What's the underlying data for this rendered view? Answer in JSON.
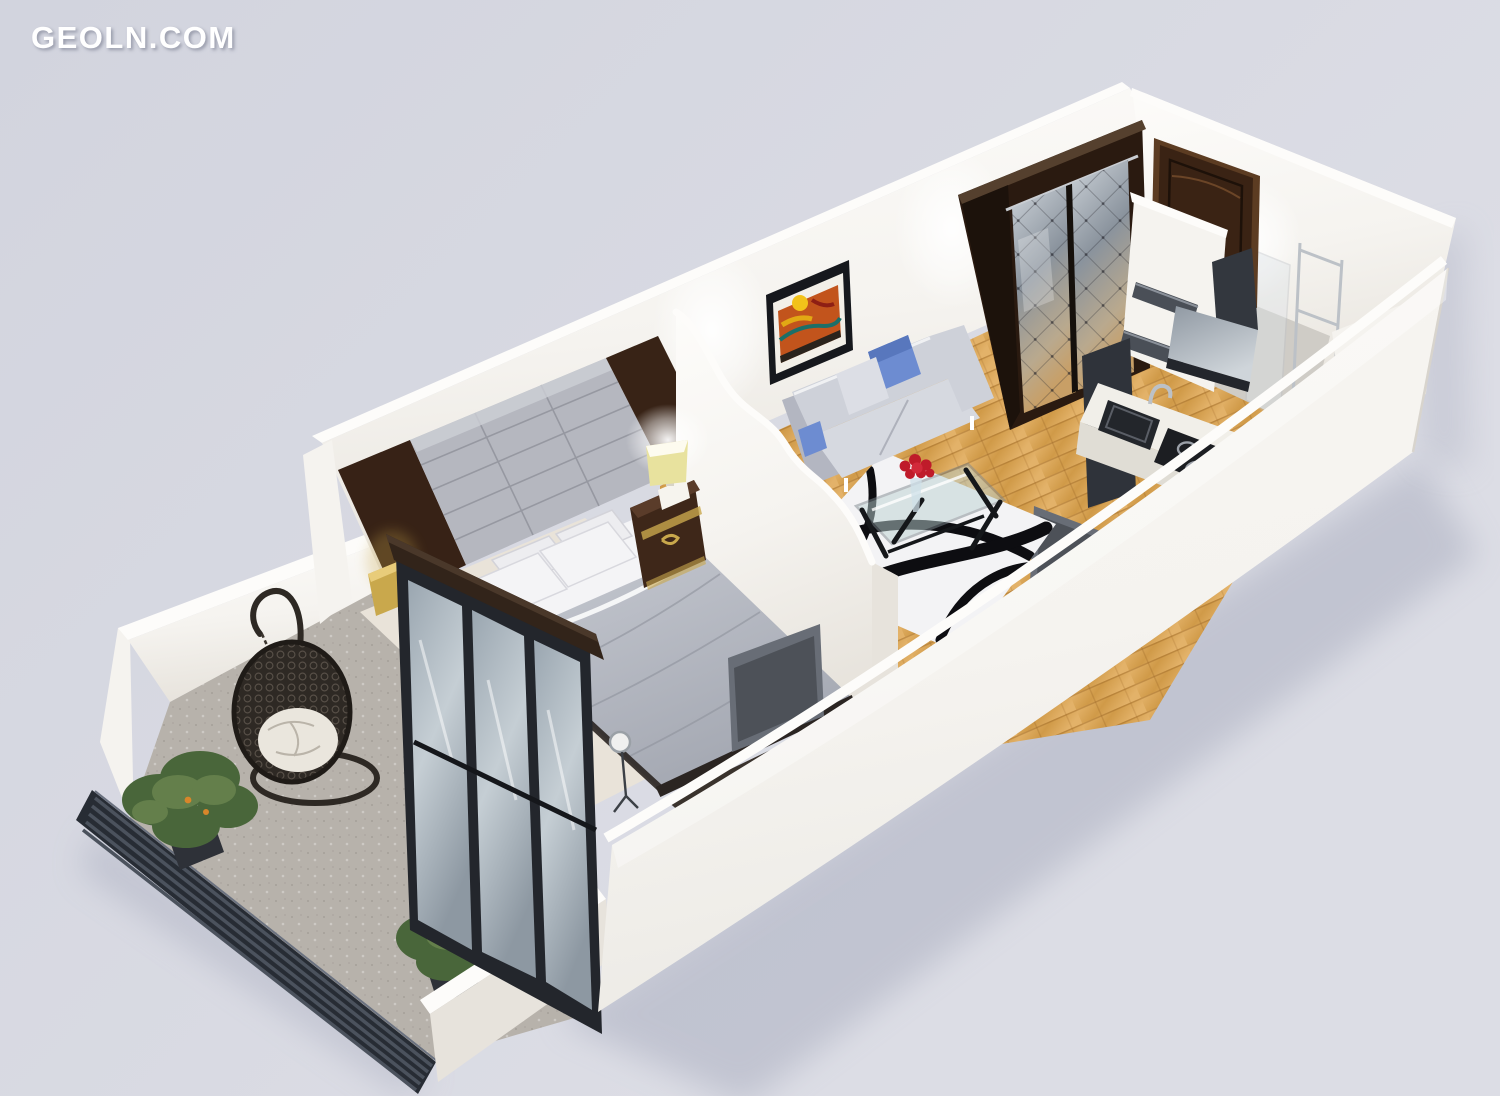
{
  "watermark": {
    "text": "GEOLN.COM"
  },
  "palette": {
    "bg1": "#d2d4de",
    "bg2": "#dcdde5",
    "shadow": "#979cb1",
    "wall": "#f5f3ef",
    "wallBright": "#fdfcfa",
    "wallShade": "#e7e3dc",
    "wallDark": "#d8d4cd",
    "wood1": "#d09a48",
    "wood2": "#e3b269",
    "woodLine": "#9a6524",
    "balconyFloor": "#b7b2ab",
    "louver": "#272c34",
    "louverSlat": "#4b525d",
    "darkWood": "#3e2719",
    "darkWood2": "#2a1a10",
    "panelGray": "#b5b7bf",
    "panelSeam": "#83858e",
    "mirror1": "#cdd3d9",
    "mirror2": "#8a939d",
    "doorBrown": "#3a2314",
    "doorEdge": "#5c3c22",
    "sofa": "#ced1d9",
    "sofaShade": "#b3b6c1",
    "pillowBlue": "#6d8cd1",
    "pillowBlueDk": "#5877bd",
    "duvet1": "#c6c9d1",
    "duvet2": "#a3a7b1",
    "pillowWhite": "#f4f4f6",
    "bedFrame": "#2b2522",
    "rugWhite": "#f3f3f5",
    "rugInk": "#0d0d11",
    "glassEdge": "#7e898f",
    "accentRed": "#bf1b2a",
    "lampYellow": "#e8e29e",
    "gold": "#c9a84c",
    "green1": "#49663a",
    "green2": "#647f4b",
    "chairDark": "#2e2924",
    "cushion": "#eae6dd",
    "tvGray": "#686d76",
    "tvDark": "#4d5158",
    "kitchenDark": "#363b42",
    "steel": "#bcc1c7",
    "black": "#1b1d22"
  }
}
